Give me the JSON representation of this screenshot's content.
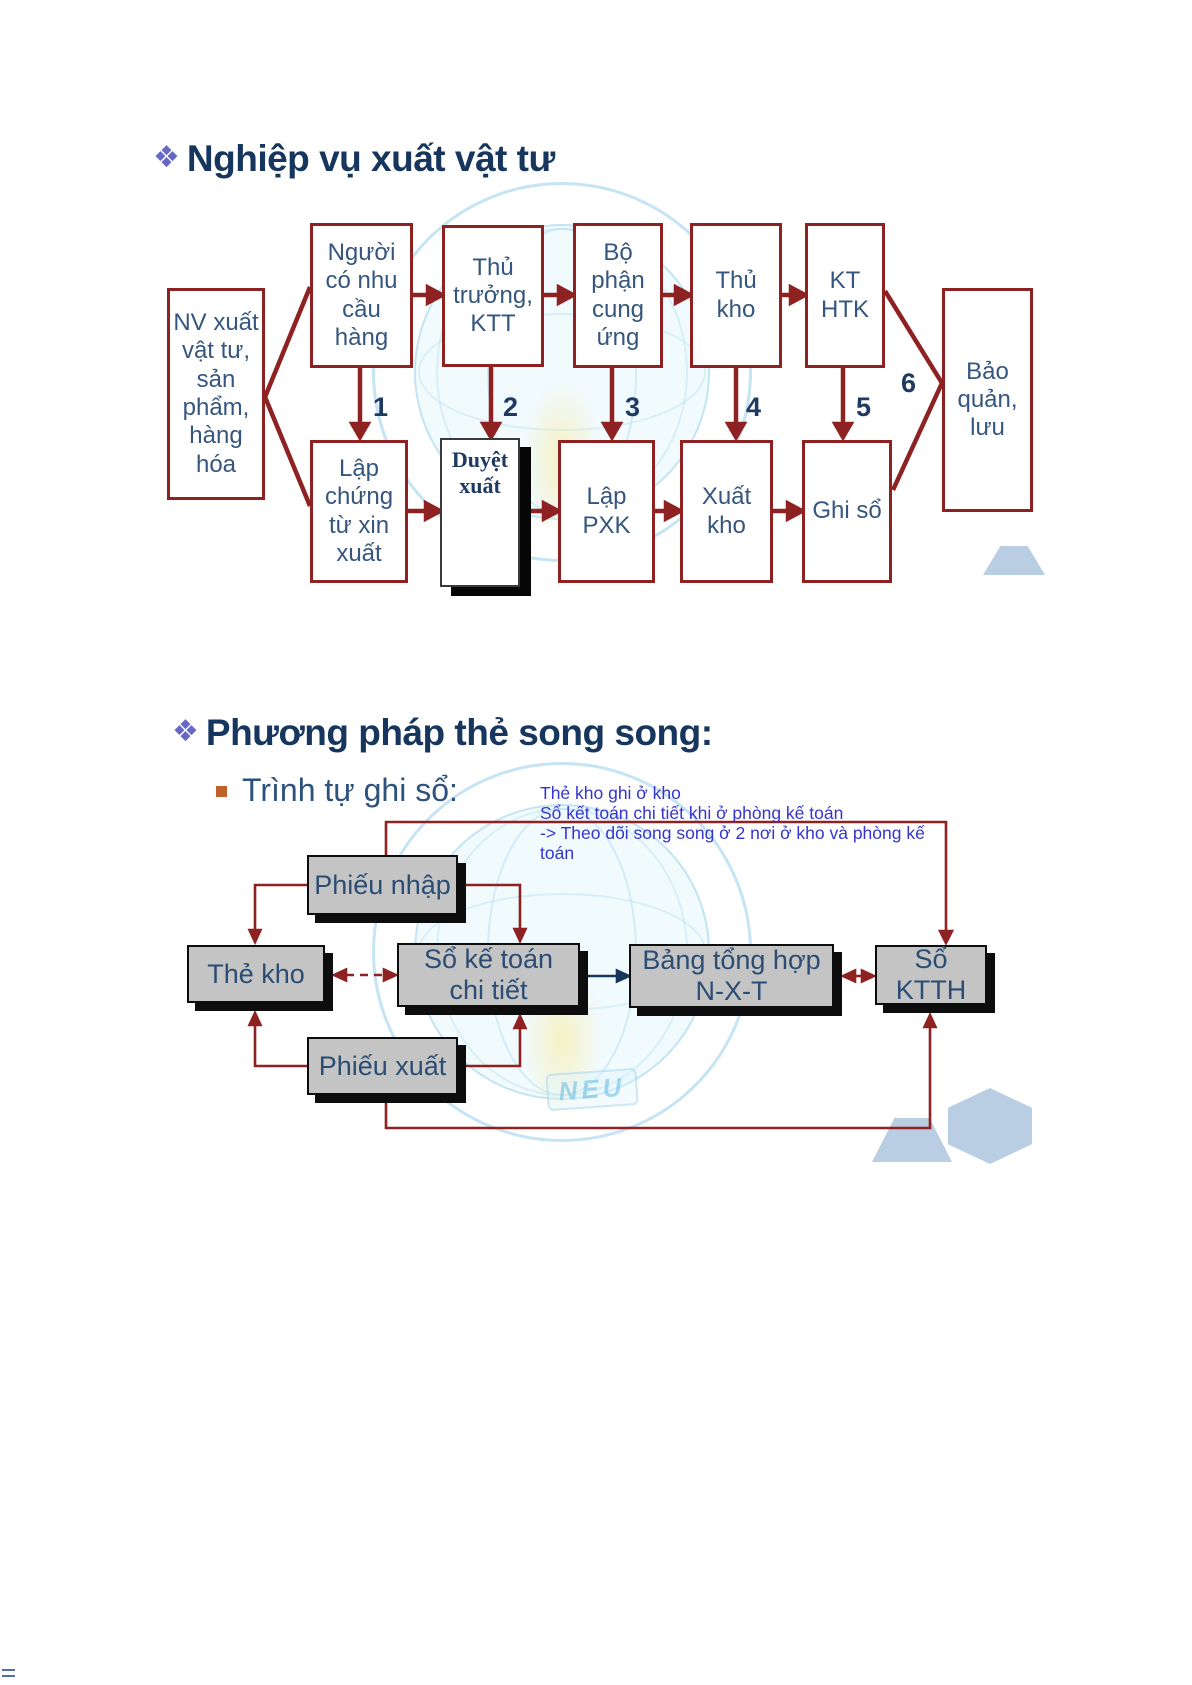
{
  "slide1": {
    "bullet": "❖",
    "title": "Nghiệp vụ xuất vật tư",
    "left_box": "NV xuất vật tư, sản phẩm, hàng hóa",
    "top_row": [
      "Người có nhu cầu hàng",
      "Thủ trưởng, KTT",
      "Bộ phận cung ứng",
      "Thủ kho",
      "KT HTK"
    ],
    "bottom_row": [
      "Lập chứng từ xin xuất",
      "Duyệt xuất",
      "Lập PXK",
      "Xuất kho",
      "Ghi sổ"
    ],
    "right_box": "Bảo quản, lưu",
    "steps": [
      "1",
      "2",
      "3",
      "4",
      "5",
      "6"
    ],
    "edges": [
      "NV xuất vật tư -> Người có nhu cầu hàng",
      "NV xuất vật tư -> Lập chứng từ xin xuất",
      "Người có nhu cầu hàng -> Thủ trưởng, KTT",
      "Thủ trưởng, KTT -> Bộ phận cung ứng",
      "Bộ phận cung ứng -> Thủ kho",
      "Thủ kho -> KT HTK",
      "Người có nhu cầu hàng -> Lập chứng từ xin xuất (1)",
      "Thủ trưởng, KTT -> Duyệt xuất (2)",
      "Bộ phận cung ứng -> Lập PXK (3)",
      "Thủ kho -> Xuất kho (4)",
      "KT HTK -> Ghi sổ (5)",
      "KT HTK / Ghi sổ -> Bảo quản, lưu (6)",
      "Lập chứng từ xin xuất -> Duyệt xuất -> Lập PXK -> Xuất kho -> Ghi sổ"
    ]
  },
  "slide2": {
    "bullet": "❖",
    "title": "Phương pháp thẻ song song:",
    "subbullet_label": "Trình tự ghi sổ:",
    "notes": [
      "Thẻ kho ghi ở kho",
      "Sổ kết toán chi tiết khi ở phòng kế toán",
      "-> Theo dõi song song ở 2 nơi ở kho và phòng kế",
      "toán"
    ],
    "nodes": {
      "phieu_nhap": "Phiếu nhập",
      "the_kho": "Thẻ kho",
      "so_ke_toan_chi_tiet": "Sổ kế toán chi tiết",
      "bang_tong_hop": "Bảng tổng hợp N-X-T",
      "so_ktth": "Sổ KTTH",
      "phieu_xuat": "Phiếu xuất"
    },
    "edges": [
      "Phiếu nhập -> Thẻ kho",
      "Phiếu nhập -> Sổ kế toán chi tiết",
      "Phiếu nhập -> Sổ KTTH (vòng trên)",
      "Thẻ kho <-> Sổ kế toán chi tiết (nét đứt)",
      "Phiếu xuất -> Thẻ kho",
      "Phiếu xuất -> Sổ kế toán chi tiết",
      "Phiếu xuất -> Sổ KTTH (vòng dưới)",
      "Sổ kế toán chi tiết -> Bảng tổng hợp N-X-T",
      "Bảng tổng hợp N-X-T <-> Sổ KTTH"
    ],
    "watermark_text": "NEU"
  },
  "colors": {
    "title_navy": "#17365D",
    "box_border_red": "#8E2222",
    "box_text_blue": "#35567E",
    "connector_red": "#8E2222",
    "connector_blue": "#17365D",
    "note_blue": "#3535CE",
    "node_gray_fill": "#C4C4C4",
    "bullet_purple": "#6767C9",
    "bullet_orange": "#C0622C",
    "hexagon_blue": "#B9CDE3"
  }
}
